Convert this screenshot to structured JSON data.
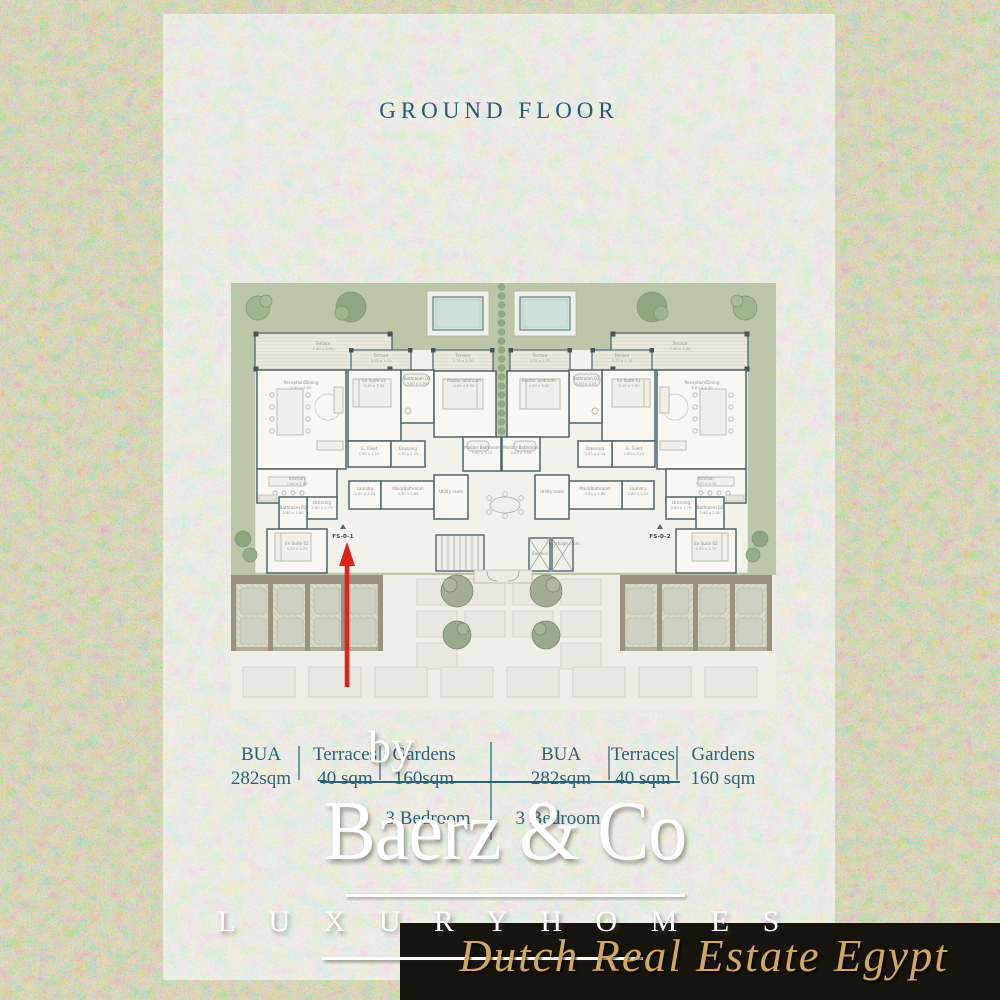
{
  "title": "GROUND FLOOR",
  "plan": {
    "unit_labels": [
      {
        "id": "FS-0-1",
        "x": 112,
        "y": 255
      },
      {
        "id": "FS-0-2",
        "x": 429,
        "y": 255
      }
    ],
    "labels": [
      {
        "text": "Terrace",
        "dims": "7.40 x 3.00",
        "x": 92,
        "y": 62,
        "mirror": true
      },
      {
        "text": "Terrace",
        "dims": "3.75 x 1.70",
        "x": 150,
        "y": 74,
        "mirror": true
      },
      {
        "text": "Terrace",
        "dims": "3.75 x 1.70",
        "x": 232,
        "y": 74,
        "mirror": true
      },
      {
        "text": "Reception/Dining",
        "dims": "7.00 x 5.55",
        "x": 70,
        "y": 101,
        "mirror": false
      },
      {
        "text": "Reception/Dining",
        "dims": "6.80 x 4.70",
        "x": 471,
        "y": 101,
        "mirror": false
      },
      {
        "text": "En Suite 03",
        "dims": "5.10 x 3.50",
        "x": 143,
        "y": 99,
        "mirror": false
      },
      {
        "text": "En Suite 01",
        "dims": "5.10 x 3.50",
        "x": 398,
        "y": 99,
        "mirror": false
      },
      {
        "text": "Bathroom 03",
        "dims": "3.00 x 1.55",
        "x": 186,
        "y": 97,
        "mirror": false
      },
      {
        "text": "Bathroom 01",
        "dims": "3.00 x 1.55",
        "x": 355,
        "y": 97,
        "mirror": false
      },
      {
        "text": "Master Bedroom",
        "dims": "4.00 x 3.50",
        "x": 233,
        "y": 99,
        "mirror": true
      },
      {
        "text": "Master Bathroom",
        "dims": "3.90 x 3.23",
        "x": 251,
        "y": 166,
        "mirror": false
      },
      {
        "text": "Master Bathroom",
        "dims": "4.05 x 3.00",
        "x": 290,
        "y": 166,
        "mirror": false
      },
      {
        "text": "G. Toilet",
        "dims": "2.90 x 1.15",
        "x": 138,
        "y": 167,
        "mirror": true
      },
      {
        "text": "Dressing",
        "dims": "3.35 x 2.25",
        "x": 177,
        "y": 167,
        "mirror": true
      },
      {
        "text": "Kitchen",
        "dims": "7.00 x 2.90",
        "x": 66,
        "y": 197,
        "mirror": false
      },
      {
        "text": "Kitchen",
        "dims": "7.00 x 3.35",
        "x": 475,
        "y": 197,
        "mirror": false
      },
      {
        "text": "Dressing",
        "dims": "2.60 x 1.75",
        "x": 91,
        "y": 221,
        "mirror": true
      },
      {
        "text": "Bathroom 02",
        "dims": "2.60 x 2.50",
        "x": 62,
        "y": 226,
        "mirror": true
      },
      {
        "text": "En Suite 02",
        "dims": "4.35 x 3.70",
        "x": 66,
        "y": 262,
        "mirror": true
      },
      {
        "text": "Laundry",
        "dims": "2.60 x 1.55",
        "x": 134,
        "y": 207,
        "mirror": true
      },
      {
        "text": "Maid/Bathroom",
        "dims": "4.30 x 2.60",
        "x": 177,
        "y": 207,
        "mirror": true
      },
      {
        "text": "Utility room",
        "dims": "",
        "x": 220,
        "y": 210,
        "mirror": true
      },
      {
        "text": "Balance",
        "dims": "",
        "x": 309,
        "y": 272,
        "mirror": false
      },
      {
        "text": "Garbage room",
        "dims": "",
        "x": 334,
        "y": 262,
        "mirror": false
      }
    ]
  },
  "spec": {
    "groups": [
      {
        "cols": [
          {
            "label": "BUA",
            "value": "282sqm"
          },
          {
            "label": "Terraces",
            "value": "40 sqm"
          },
          {
            "label": "Gardens",
            "value": "160sqm"
          }
        ],
        "bedrooms": "3 Bedroom"
      },
      {
        "cols": [
          {
            "label": "BUA",
            "value": "282sqm"
          },
          {
            "label": "Terraces",
            "value": "40 sqm"
          },
          {
            "label": "Gardens",
            "value": "160 sqm"
          }
        ],
        "bedrooms": "3 Bedroom"
      }
    ]
  },
  "watermark": {
    "by": "by",
    "brand": "Baerz & Co",
    "tagline": "L U X U R Y   H O M E S"
  },
  "banner": {
    "text": "Dutch Real Estate Egypt"
  },
  "colors": {
    "title_text": "#23597a",
    "table_text": "#2c6175",
    "arrow_red": "#e02318",
    "banner_bg": "#17130d",
    "banner_gold": "#d2a75f",
    "watermark_white": "#ffffff",
    "garden_green": "#bcc7aa",
    "pool_water": "#cfdfd9",
    "wall": "#50646a",
    "pergola_frame": "#9a9181",
    "outer_background": "#e7e0c1",
    "panel_background": "#f4f2ec"
  }
}
